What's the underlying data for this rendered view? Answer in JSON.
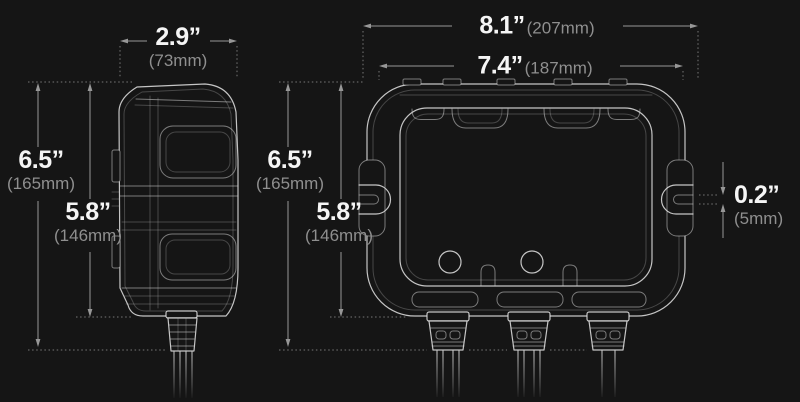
{
  "diagram": {
    "description": "Battery charger product dimensions diagram, side view and front view wireframes",
    "background": "#151515",
    "colors": {
      "inch_text": "#f5f5f5",
      "mm_text": "#8f8f8f",
      "dimension_lines": "#979797",
      "wireframe": "#e4e4e4"
    },
    "side_view": {
      "width": {
        "inches": "2.9”",
        "mm": "(73mm)"
      },
      "height_overall": {
        "inches": "6.5”",
        "mm": "(165mm)"
      },
      "height_body": {
        "inches": "5.8”",
        "mm": "(146mm)"
      }
    },
    "front_view": {
      "width_overall": {
        "inches": "8.1”",
        "mm": "(207mm)"
      },
      "width_body": {
        "inches": "7.4”",
        "mm": "(187mm)"
      },
      "height_overall": {
        "inches": "6.5”",
        "mm": "(165mm)"
      },
      "height_body": {
        "inches": "5.8”",
        "mm": "(146mm)"
      },
      "slot_width": {
        "inches": "0.2”",
        "mm": "(5mm)"
      }
    }
  }
}
